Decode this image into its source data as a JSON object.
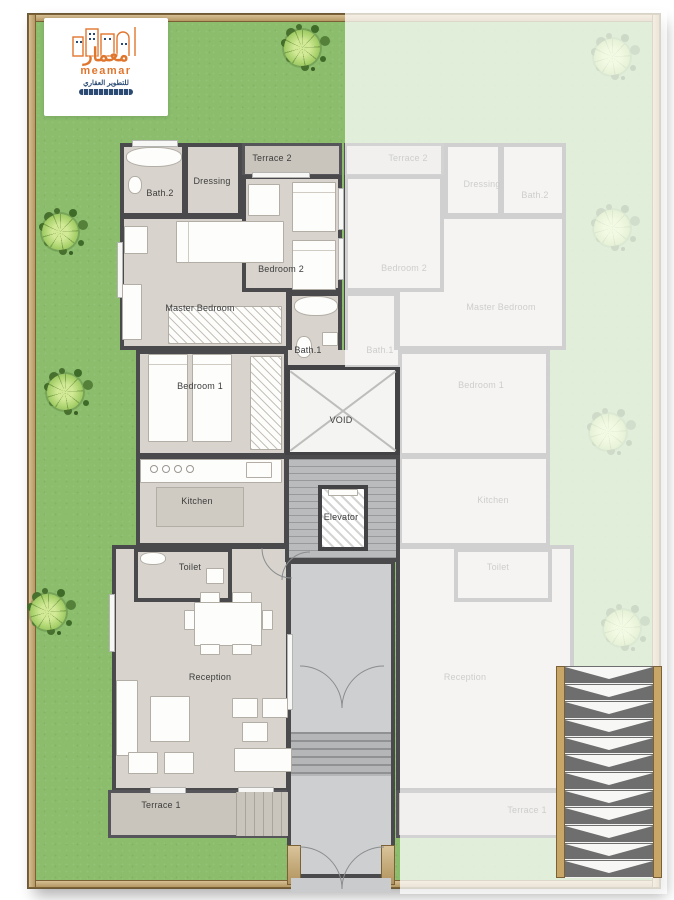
{
  "logo": {
    "brand_arabic": "معمار",
    "brand_latin": "meamar",
    "tagline_arabic": "للتطوير العقاري"
  },
  "floor_plan": {
    "core": {
      "void": "VOID",
      "elevator": "Elevator"
    },
    "left_unit": {
      "terrace_2": "Terrace 2",
      "dressing": "Dressing",
      "bath_2": "Bath.2",
      "bedroom_2": "Bedroom 2",
      "master_bedroom": "Master Bedroom",
      "bath_1": "Bath.1",
      "bedroom_1": "Bedroom 1",
      "kitchen": "Kitchen",
      "toilet": "Toilet",
      "reception": "Reception",
      "terrace_1": "Terrace 1"
    },
    "right_unit": {
      "terrace_2": "Terrace 2",
      "dressing": "Dressing",
      "bath_2": "Bath.2",
      "bedroom_2": "Bedroom 2",
      "master_bedroom": "Master Bedroom",
      "bath_1": "Bath.1",
      "bedroom_1": "Bedroom 1",
      "kitchen": "Kitchen",
      "toilet": "Toilet",
      "reception": "Reception",
      "terrace_1": "Terrace 1"
    }
  },
  "colors": {
    "lawn_green": "#8bbd6d",
    "fence_tan": "#c8a668",
    "wall_dark": "#4a4a4c",
    "floor_beige": "#d8d4cd",
    "terrace_gray": "#c9c5bc",
    "core_gray": "#b9bbbd",
    "accent_orange": "#e0762e",
    "brand_navy": "#2a4a74"
  }
}
